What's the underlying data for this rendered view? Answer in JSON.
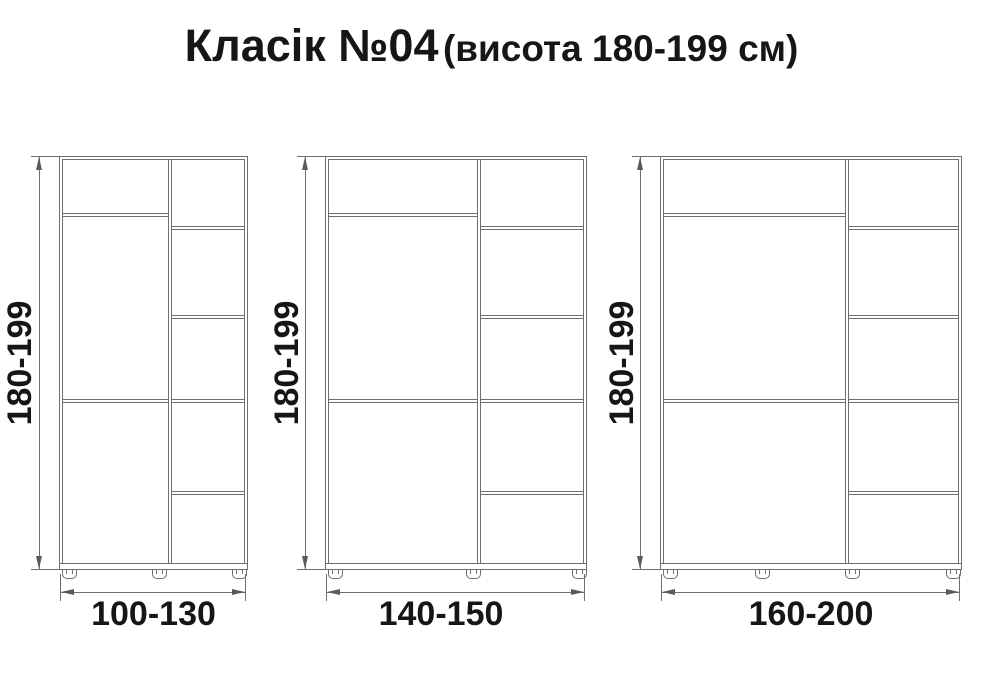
{
  "title": {
    "main": "Класік №04",
    "sub": "(висота 180-199 см)"
  },
  "wardrobes": [
    {
      "height_label": "180-199",
      "width_label": "100-130"
    },
    {
      "height_label": "180-199",
      "width_label": "140-150"
    },
    {
      "height_label": "180-199",
      "width_label": "160-200"
    }
  ],
  "colors": {
    "line": "#6f6f6f",
    "arrow": "#5a5a5a",
    "text": "#161616",
    "background": "#ffffff"
  }
}
